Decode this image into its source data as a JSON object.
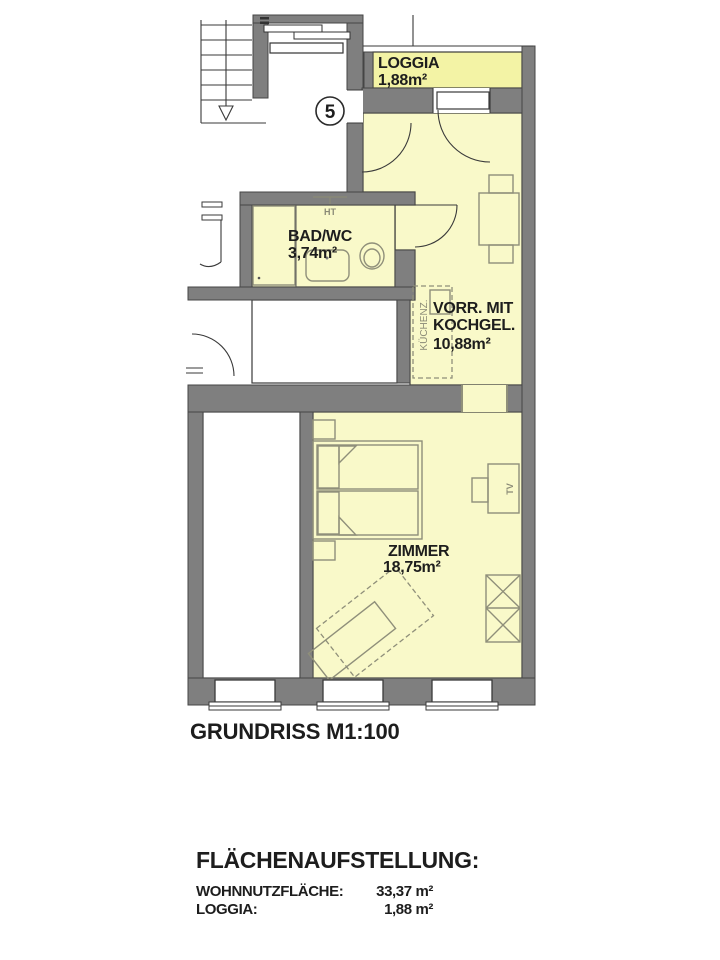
{
  "plan": {
    "unit_badge": "5",
    "title": "GRUNDRISS M1:100",
    "rooms": {
      "loggia": {
        "name": "LOGGIA",
        "area": "1,88m²"
      },
      "bad_wc": {
        "name": "BAD/WC",
        "area": "3,74m²"
      },
      "vorraum": {
        "name_line1": "VORR. MIT",
        "name_line2": "KOCHGEL.",
        "area": "10,88m²"
      },
      "zimmer": {
        "name": "ZIMMER",
        "area": "18,75m²"
      }
    },
    "annotations": {
      "heizung": "HT",
      "kuechenzeile": "KÜCHENZ.",
      "tv": "TV"
    }
  },
  "area_summary": {
    "heading": "FLÄCHENAUFSTELLUNG:",
    "rows": [
      {
        "label": "WOHNNUTZFLÄCHE:",
        "value": "33,37 m²"
      },
      {
        "label": "LOGGIA:",
        "value": "1,88 m²"
      }
    ]
  },
  "colors": {
    "room_fill": "#f9f9c9",
    "loggia_fill": "#f3f3a5",
    "wall_fill": "#7f7f7f",
    "outline": "#3a3a3a",
    "furniture_line": "#8f8f7a"
  }
}
